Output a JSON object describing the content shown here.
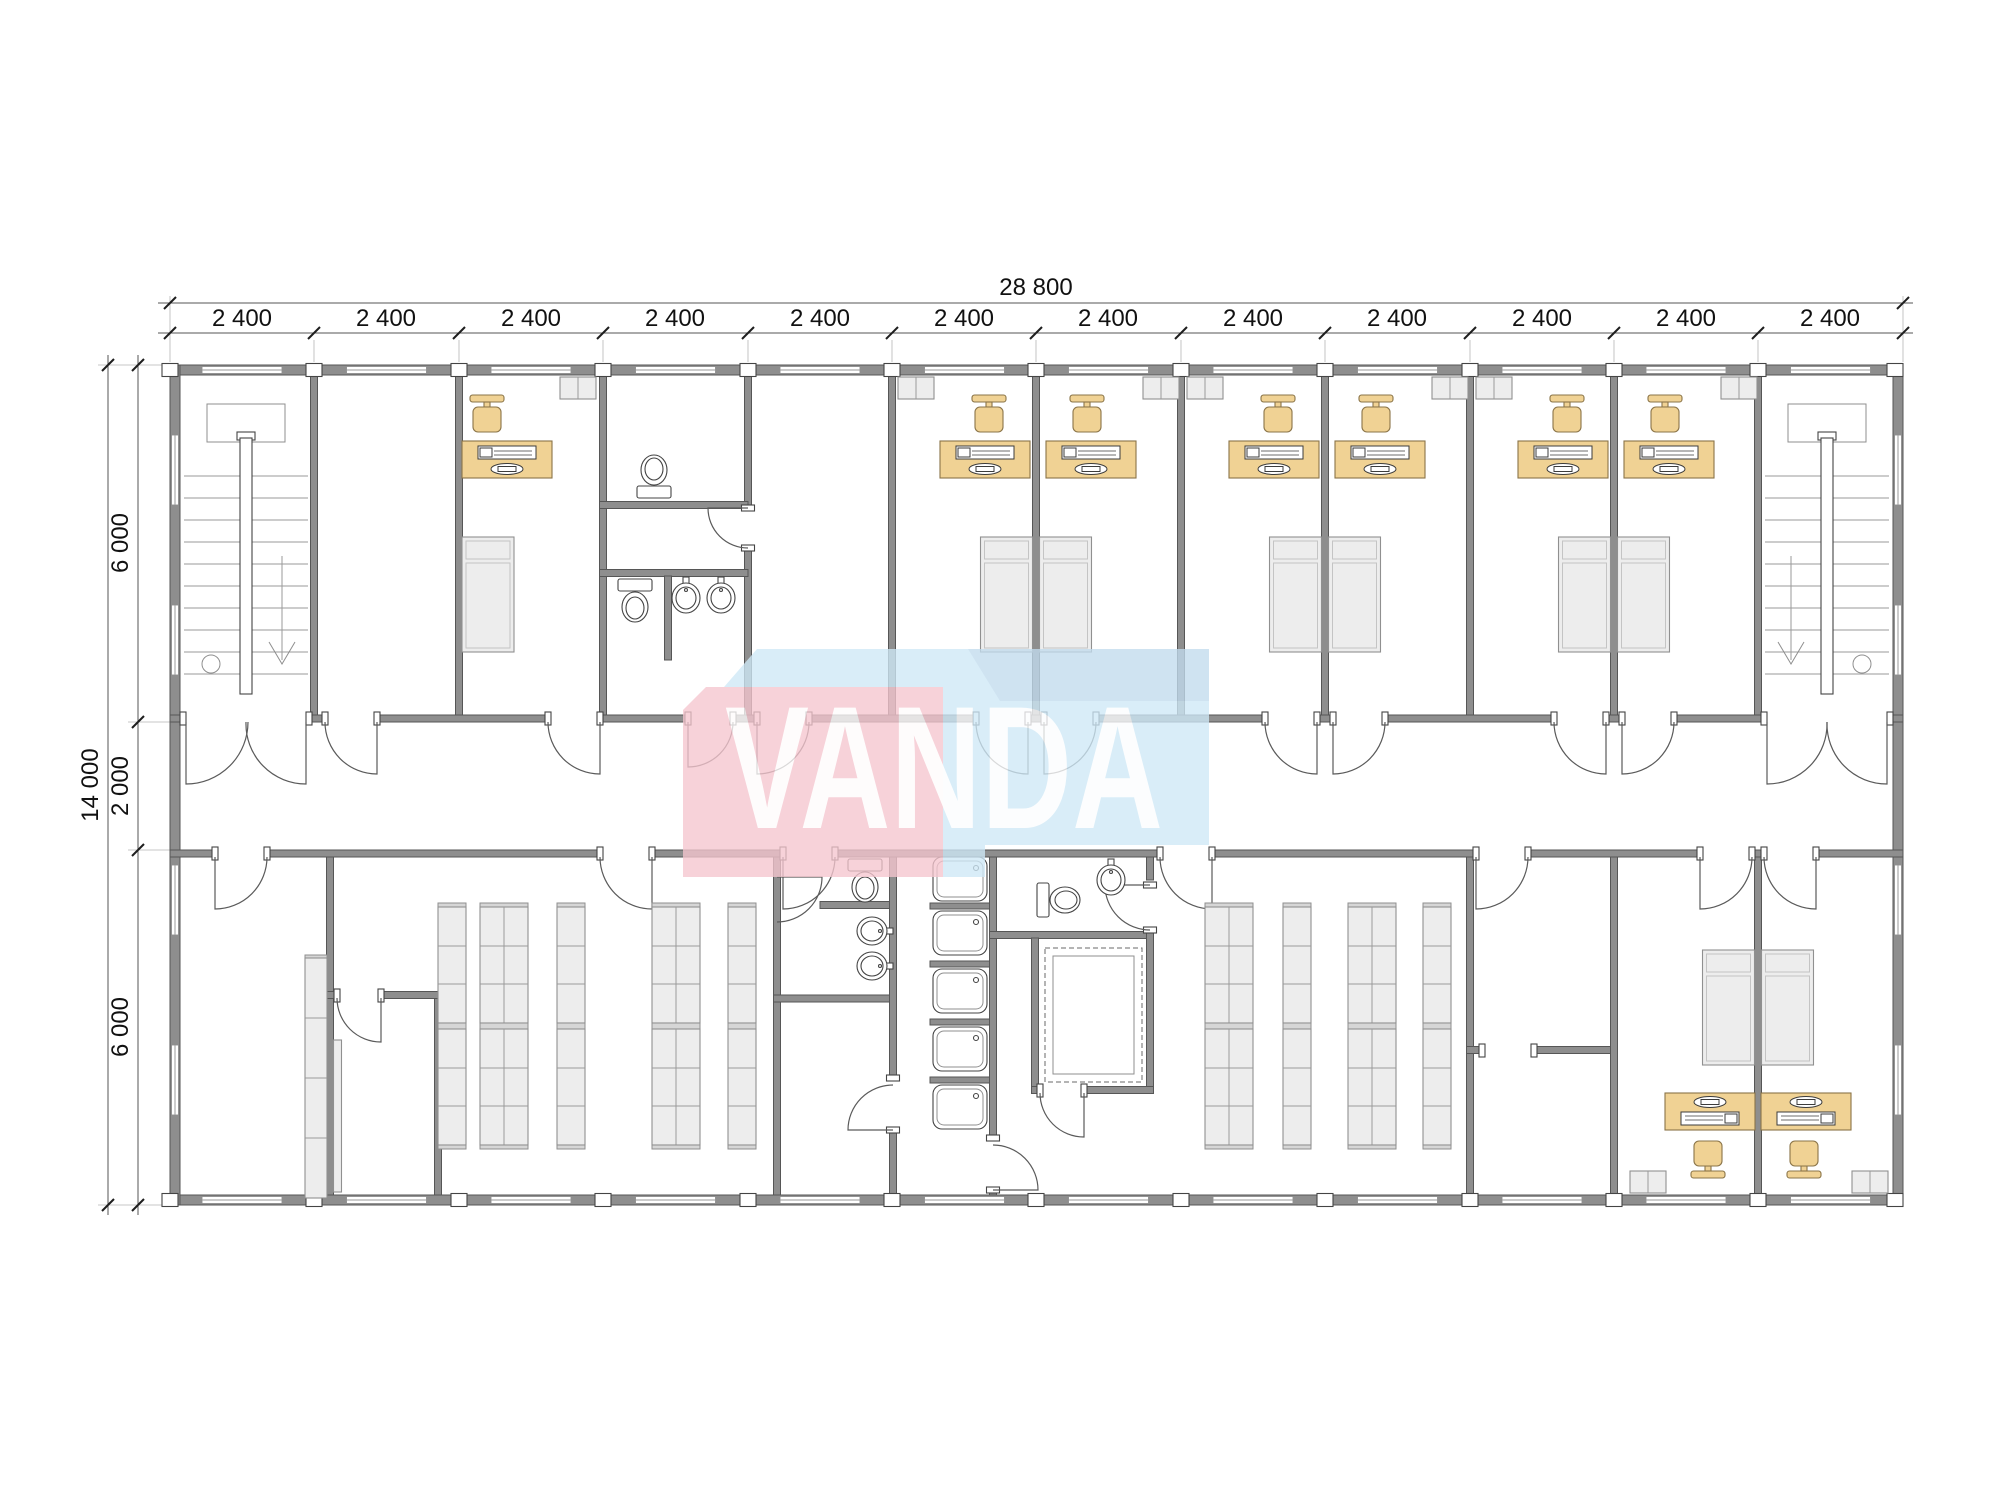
{
  "drawing": {
    "type": "modular-building-floor-plan",
    "view": "top-down architectural plan, one storey"
  },
  "dims": {
    "top": {
      "total": "28 800",
      "segments": [
        "2 400",
        "2 400",
        "2 400",
        "2 400",
        "2 400",
        "2 400",
        "2 400",
        "2 400",
        "2 400",
        "2 400",
        "2 400",
        "2 400"
      ]
    },
    "left": {
      "total": "14 000",
      "segments": [
        "6 000",
        "2 000",
        "6 000"
      ]
    }
  },
  "watermark": {
    "text": "VANDA",
    "pink": "#f5c6cf",
    "blue": "#cfe9f7",
    "text_color": "#ffffff"
  },
  "palette": {
    "wall": "#8e8e8e",
    "wall_edge": "#565656",
    "furniture_wood": "#f0d294",
    "furniture_wood_edge": "#8a7448",
    "fixture_gray": "#ededed",
    "line": "#555555",
    "dim_text": "#111111",
    "background": "#ffffff"
  },
  "rooms": [
    "stairwell-west",
    "lobby",
    "office-1",
    "wc-north",
    "bathroom-north",
    "vestibule",
    "office-2",
    "office-3",
    "office-4",
    "office-5",
    "office-6",
    "office-7",
    "stairwell-east",
    "corridor",
    "storage-west",
    "storeroom-small",
    "washroom-south",
    "shower-room",
    "wc-south",
    "sauna",
    "storage-east",
    "storeroom-1",
    "storeroom-2",
    "office-south-1",
    "office-south-2"
  ],
  "fixtures": {
    "staircases": 2,
    "desks_with_computers": 9,
    "office_chairs": 9,
    "beds": 9,
    "wardrobes": 9,
    "toilets": 4,
    "sinks": 5,
    "shower_cabins": 5,
    "shelving_racks": 11,
    "sauna_bench_rooms": 1
  }
}
